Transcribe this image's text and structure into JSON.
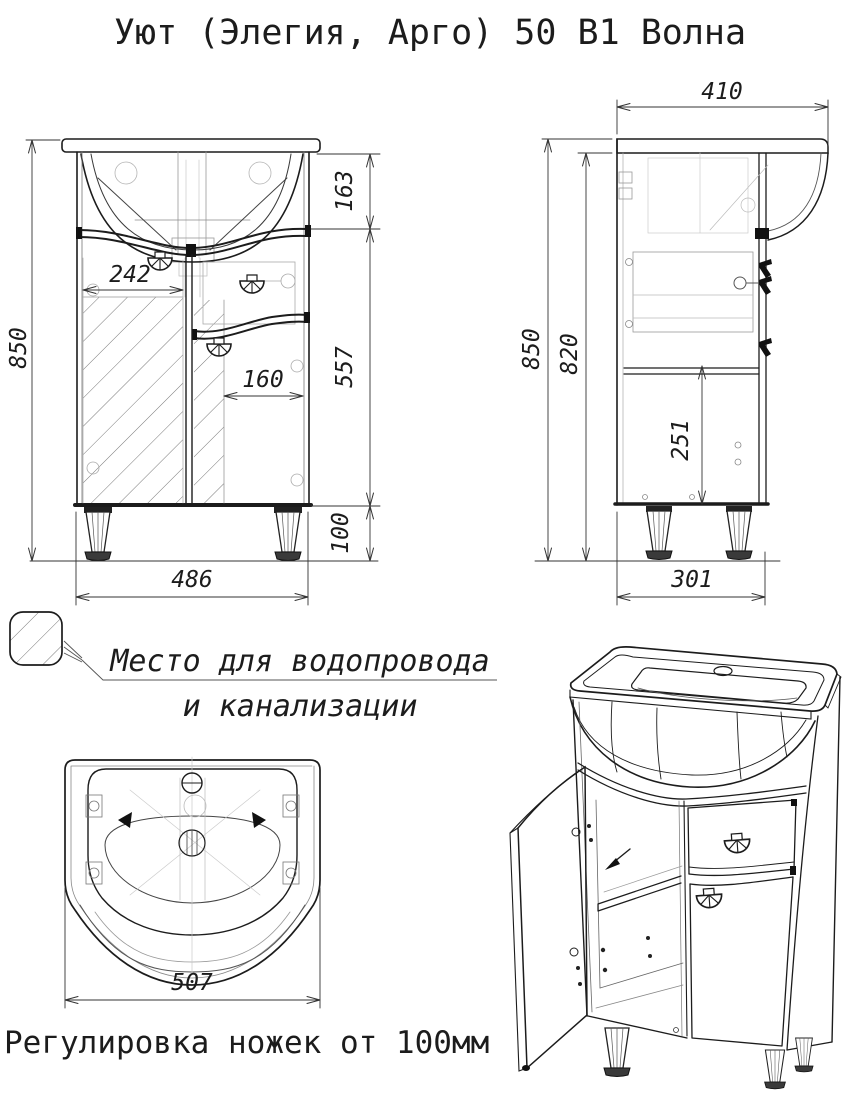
{
  "title": "Уют (Элегия, Арго) 50 В1 Волна",
  "colors": {
    "ink": "#1c1c1c",
    "background": "#ffffff"
  },
  "front_view": {
    "overall_height": "850",
    "sink_section_height": "163",
    "cabinet_section_height": "557",
    "legs_section_height": "100",
    "left_door_width": "242",
    "right_door_width": "160",
    "overall_width": "486"
  },
  "side_view": {
    "overall_depth": "410",
    "overall_height": "850",
    "cabinet_height": "820",
    "inner_height": "251",
    "bottom_depth": "301"
  },
  "top_view": {
    "sink_width": "507"
  },
  "legend": {
    "note_line1": "Место для водопровода",
    "note_line2": "и канализации"
  },
  "footnote": "Регулировка ножек от 100мм"
}
